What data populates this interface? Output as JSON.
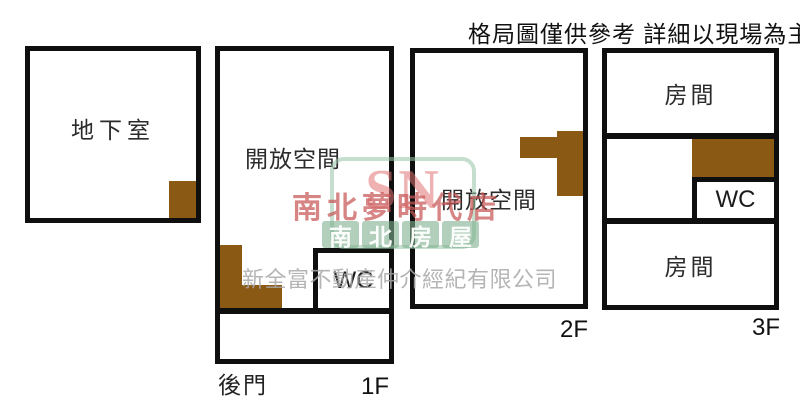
{
  "disclaimer": "格局圖僅供參考 詳細以現場為主",
  "plans": {
    "basement": {
      "label": "地下室"
    },
    "f1": {
      "room": "開放空間",
      "wc": "WC",
      "back_door": "後門",
      "floor_tag": "1F"
    },
    "f2": {
      "room": "開放空間",
      "floor_tag": "2F"
    },
    "f3": {
      "room_top": "房間",
      "wc": "WC",
      "room_bottom": "房間",
      "floor_tag": "3F"
    }
  },
  "watermark": {
    "monogram": "SN",
    "brand_blocks": [
      "南",
      "北",
      "房",
      "屋"
    ],
    "store_name": "南北夢時代店",
    "company": "新全富不動產仲介經紀有限公司"
  },
  "colors": {
    "wall": "#0f0f0f",
    "stairs": "#8a5a15",
    "watermark_red": "#c85555",
    "watermark_green": "#7daf8c",
    "watermark_gray": "#a8a8a8"
  }
}
